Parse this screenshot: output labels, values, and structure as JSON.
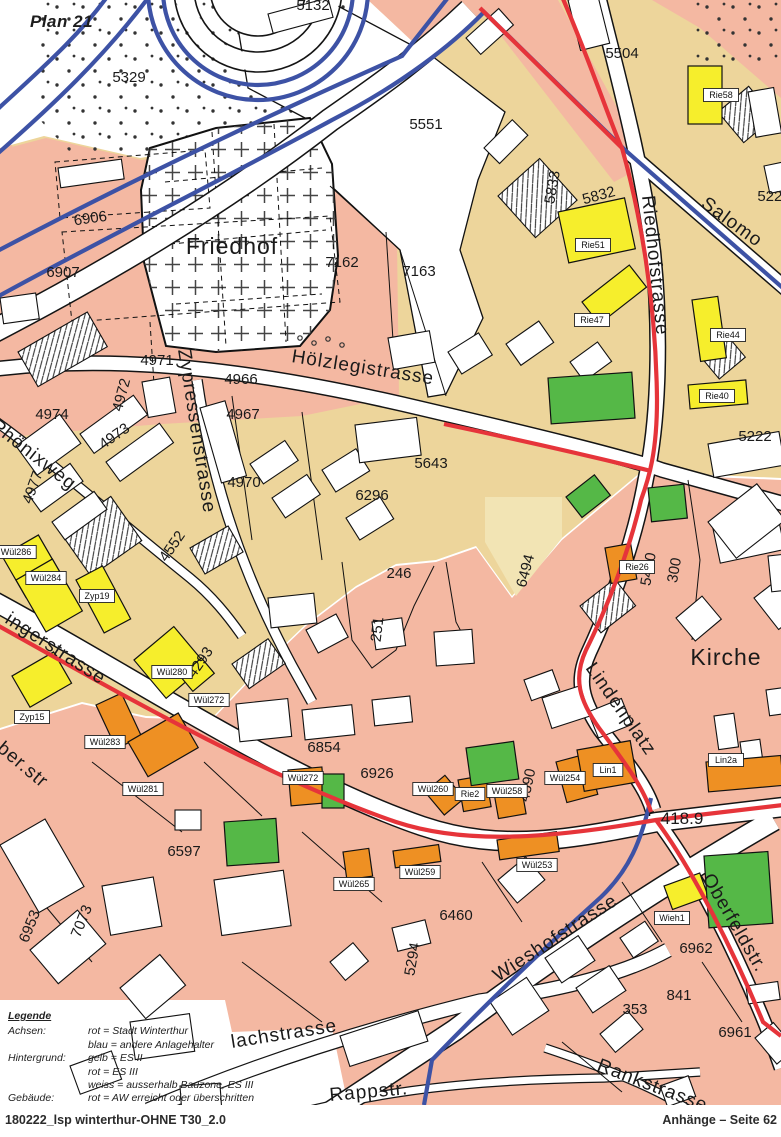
{
  "page": {
    "plan_title": "Plan 21",
    "footer_left": "180222_lsp winterthur-OHNE T30_2.0",
    "footer_right": "Anhänge – Seite 62"
  },
  "legend": {
    "title": "Legende",
    "rows": [
      {
        "label": "Achsen:",
        "value": "rot = Stadt Winterthur"
      },
      {
        "label": "",
        "value": "blau = andere Anlagehalter"
      },
      {
        "label": "Hintergrund:",
        "value": "gelb = ES II"
      },
      {
        "label": "",
        "value": "rot = ES III"
      },
      {
        "label": "",
        "value": "weiss = ausserhalb Bauzone, ES III"
      },
      {
        "label": "Gebäude:",
        "value": "rot = AW erreicht oder überschritten"
      },
      {
        "label": "",
        "value": "orange = AW-5 überschritten"
      },
      {
        "label": "",
        "value": "gelb = IGW überschritten"
      },
      {
        "label": "",
        "value": "grün = IGW nicht überschritten"
      }
    ]
  },
  "colors": {
    "zone_es2_gelb": "#EDD59B",
    "zone_es3_rot": "#F4B8A2",
    "zone_mix_pale": "#F2E4B4",
    "building_gelb": "#F6EE2C",
    "building_orange": "#EE9023",
    "building_gruen": "#55B847",
    "achse_rot": "#E6343A",
    "achse_blau": "#3D52A5"
  },
  "map": {
    "area_labels": [
      {
        "text": "Friedhof",
        "x": 232,
        "y": 254
      },
      {
        "text": "Kirche",
        "x": 726,
        "y": 665
      }
    ],
    "street_labels": [
      {
        "text": "Hölzlegistrasse",
        "x": 291,
        "y": 362,
        "r": 9,
        "s": 21,
        "ls": 1
      },
      {
        "text": "Zypressenstrasse",
        "x": 178,
        "y": 350,
        "r": 81,
        "s": 20,
        "ls": 3
      },
      {
        "text": "Phönixweg",
        "x": -10,
        "y": 428,
        "r": 38,
        "s": 20,
        "ls": 1
      },
      {
        "text": "Riedhofstrasse",
        "x": 642,
        "y": 196,
        "r": 84,
        "s": 21,
        "ls": 2
      },
      {
        "text": "Salomo",
        "x": 700,
        "y": 206,
        "r": 36,
        "s": 21,
        "ls": 3
      },
      {
        "text": "ingerstrasse",
        "x": 4,
        "y": 622,
        "r": 33,
        "s": 22,
        "ls": 2
      },
      {
        "text": "ber.str",
        "x": -4,
        "y": 750,
        "r": 40,
        "s": 14,
        "ls": 0
      },
      {
        "text": "Lindenplatz",
        "x": 585,
        "y": 668,
        "r": 55,
        "s": 17,
        "ls": 1
      },
      {
        "text": "Wieshofstrasse",
        "x": 498,
        "y": 982,
        "r": -33,
        "s": 22,
        "ls": 3
      },
      {
        "text": "Oberfeldstr.",
        "x": 702,
        "y": 878,
        "r": 60,
        "s": 18,
        "ls": 1
      },
      {
        "text": "lachstrasse",
        "x": 232,
        "y": 1048,
        "r": -9,
        "s": 19,
        "ls": 2
      },
      {
        "text": "Rappstr.",
        "x": 330,
        "y": 1101,
        "r": -5,
        "s": 16,
        "ls": 1
      },
      {
        "text": "Rankstrasse",
        "x": 596,
        "y": 1070,
        "r": 21,
        "s": 16,
        "ls": 1
      }
    ],
    "parcel_labels": [
      {
        "text": "5132",
        "x": 313,
        "y": 10
      },
      {
        "text": "5329",
        "x": 129,
        "y": 82
      },
      {
        "text": "5504",
        "x": 622,
        "y": 58
      },
      {
        "text": "5551",
        "x": 426,
        "y": 129
      },
      {
        "text": "6906",
        "x": 91,
        "y": 223,
        "r": -8
      },
      {
        "text": "6907",
        "x": 63,
        "y": 277
      },
      {
        "text": "7162",
        "x": 342,
        "y": 267
      },
      {
        "text": "7163",
        "x": 419,
        "y": 276
      },
      {
        "text": "5833",
        "x": 557,
        "y": 188,
        "r": -80
      },
      {
        "text": "5832",
        "x": 600,
        "y": 200,
        "r": -15
      },
      {
        "text": "5222",
        "x": 774,
        "y": 201
      },
      {
        "text": "5222",
        "x": 755,
        "y": 441
      },
      {
        "text": "4971",
        "x": 157,
        "y": 365
      },
      {
        "text": "4966",
        "x": 241,
        "y": 384
      },
      {
        "text": "4972",
        "x": 126,
        "y": 396,
        "r": -75
      },
      {
        "text": "4967",
        "x": 243,
        "y": 419
      },
      {
        "text": "4973",
        "x": 117,
        "y": 440,
        "r": -35
      },
      {
        "text": "4974",
        "x": 52,
        "y": 419
      },
      {
        "text": "4977",
        "x": 37,
        "y": 489,
        "r": -70
      },
      {
        "text": "4970",
        "x": 244,
        "y": 487
      },
      {
        "text": "5643",
        "x": 431,
        "y": 468
      },
      {
        "text": "6296",
        "x": 372,
        "y": 500
      },
      {
        "text": "246",
        "x": 399,
        "y": 578
      },
      {
        "text": "251",
        "x": 382,
        "y": 630,
        "r": -83
      },
      {
        "text": "4552",
        "x": 176,
        "y": 549,
        "r": -55
      },
      {
        "text": "4293",
        "x": 204,
        "y": 665,
        "r": -55
      },
      {
        "text": "6494",
        "x": 530,
        "y": 572,
        "r": -75
      },
      {
        "text": "5470",
        "x": 653,
        "y": 570,
        "r": -80
      },
      {
        "text": "300",
        "x": 679,
        "y": 571,
        "r": -80
      },
      {
        "text": "6854",
        "x": 324,
        "y": 752
      },
      {
        "text": "6926",
        "x": 377,
        "y": 778
      },
      {
        "text": "4590",
        "x": 532,
        "y": 786,
        "r": -78
      },
      {
        "text": "6597",
        "x": 184,
        "y": 856
      },
      {
        "text": "6953",
        "x": 34,
        "y": 928,
        "r": -68
      },
      {
        "text": "7073",
        "x": 86,
        "y": 923,
        "r": -68
      },
      {
        "text": "5294",
        "x": 417,
        "y": 960,
        "r": -80
      },
      {
        "text": "6460",
        "x": 456,
        "y": 920
      },
      {
        "text": "353",
        "x": 635,
        "y": 1014
      },
      {
        "text": "6961",
        "x": 735,
        "y": 1037
      },
      {
        "text": "6962",
        "x": 696,
        "y": 953
      },
      {
        "text": "841",
        "x": 679,
        "y": 1000
      }
    ],
    "building_tags": [
      {
        "text": "Rie58",
        "x": 721,
        "y": 95
      },
      {
        "text": "Rie51",
        "x": 593,
        "y": 245
      },
      {
        "text": "Rie47",
        "x": 592,
        "y": 320
      },
      {
        "text": "Rie44",
        "x": 728,
        "y": 335
      },
      {
        "text": "Rie40",
        "x": 717,
        "y": 396
      },
      {
        "text": "Wül286",
        "x": 16,
        "y": 552
      },
      {
        "text": "Wül284",
        "x": 46,
        "y": 578
      },
      {
        "text": "Zyp19",
        "x": 97,
        "y": 596
      },
      {
        "text": "Zyp15",
        "x": 32,
        "y": 717
      },
      {
        "text": "Wül280",
        "x": 172,
        "y": 672
      },
      {
        "text": "Wül272",
        "x": 209,
        "y": 700
      },
      {
        "text": "Wül283",
        "x": 105,
        "y": 742
      },
      {
        "text": "Wül281",
        "x": 143,
        "y": 789
      },
      {
        "text": "Wül272",
        "x": 303,
        "y": 778
      },
      {
        "text": "Wül265",
        "x": 354,
        "y": 884
      },
      {
        "text": "Wül259",
        "x": 420,
        "y": 872
      },
      {
        "text": "Wül260",
        "x": 433,
        "y": 789
      },
      {
        "text": "Rie2",
        "x": 470,
        "y": 794
      },
      {
        "text": "Wül258",
        "x": 507,
        "y": 791
      },
      {
        "text": "Wül254",
        "x": 565,
        "y": 778
      },
      {
        "text": "Lin1",
        "x": 608,
        "y": 770
      },
      {
        "text": "Lin2a",
        "x": 726,
        "y": 760
      },
      {
        "text": "Wül253",
        "x": 537,
        "y": 865
      },
      {
        "text": "Rie26",
        "x": 637,
        "y": 567
      },
      {
        "text": "Wieh1",
        "x": 672,
        "y": 918
      }
    ],
    "spot_elevation": {
      "text": "418.9",
      "x": 682,
      "y": 824
    }
  }
}
